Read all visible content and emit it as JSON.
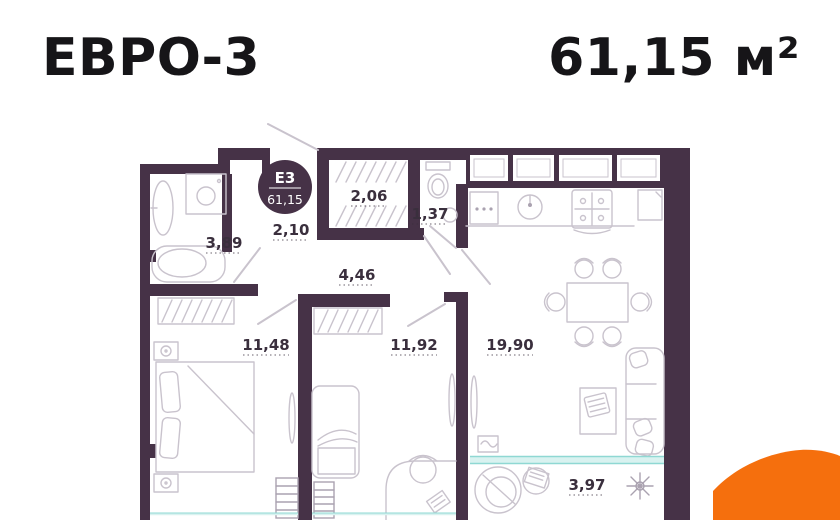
{
  "header": {
    "plan_type": "ЕВРО-3",
    "total_area": "61,15 м²"
  },
  "badge": {
    "code": "Е3",
    "area": "61,15"
  },
  "rooms": {
    "bathroom": {
      "name": "bathroom",
      "area": "3,89"
    },
    "entry_hall": {
      "name": "entry-hall",
      "area": "2,10"
    },
    "wardrobe": {
      "name": "wardrobe",
      "area": "2,06"
    },
    "wc": {
      "name": "wc",
      "area": "1,37"
    },
    "hallway": {
      "name": "hallway",
      "area": "4,46"
    },
    "bedroom_1": {
      "name": "bedroom-1",
      "area": "11,48"
    },
    "bedroom_2": {
      "name": "bedroom-2",
      "area": "11,92"
    },
    "kitchen_living": {
      "name": "kitchen-living",
      "area": "19,90"
    },
    "balcony": {
      "name": "balcony",
      "area": "3,97"
    }
  },
  "colors": {
    "wall": "#463247",
    "furniture": "#c9c3cd",
    "furniture_dark": "#aaa2b0",
    "label": "#3a2f3d",
    "title": "#161518",
    "teal_fill": "#d9f2f0",
    "teal_line": "#8fd8d3",
    "accent_orange": "#f56f0d",
    "badge_text": "#ffffff",
    "background": "#ffffff"
  }
}
